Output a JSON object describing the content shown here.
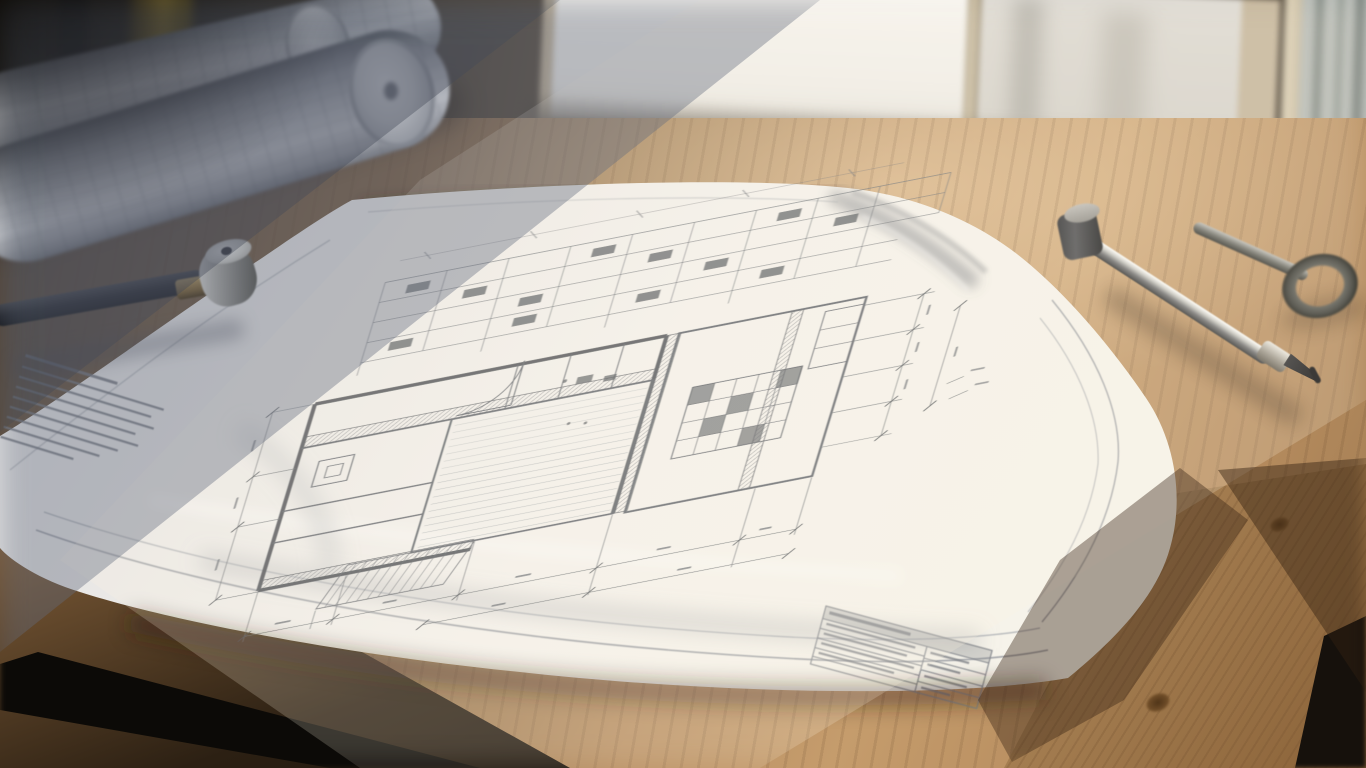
{
  "scene": {
    "type": "photograph",
    "subject": "Hand-drawn architectural blueprint lying on a wooden drafting table beside a sunlit window",
    "lighting": "warm sunlight from upper-right window, cool diagonal shadow across upper-left"
  },
  "objects": {
    "blueprint_sheet": {
      "label": "large white blueprint sheet with pencil floor plan, curled edges"
    },
    "floor_plan": {
      "label": "pencil floor plan with thick hatched walls, rooms, stairs, door-swing arc"
    },
    "elevation_grid": {
      "label": "grid-like elevation band along top of the drawing"
    },
    "dimension_lines": {
      "label": "dimension chains with oblique tick marks and illegible measurements"
    },
    "notes_block": {
      "label": "block of eight illegible note lines at left margin",
      "line_count": 8
    },
    "title_block": {
      "label": "illegible title block table at bottom-right of sheet",
      "row_count": 5
    },
    "sheet_border": {
      "label": "double ruled border following the sheet edges"
    },
    "rolled_blueprints": {
      "label": "two rolled-up blueprint sheets in shadow, top-left"
    },
    "drafting_pen": {
      "label": "black drafting pen with brass band and round steel cap"
    },
    "compass": {
      "label": "steel drafting compass with black knob, needle tip and ring handle"
    },
    "window": {
      "label": "bright window with cream frame"
    },
    "side_window": {
      "label": "narrow window pane at right edge showing blurred exterior"
    },
    "table": {
      "label": "oak table top in warm light"
    },
    "plank": {
      "label": "pine bench plank with knots, bottom-right"
    },
    "table_leg_left": {
      "label": "dark metal table leg, bottom-left"
    },
    "table_leg_right": {
      "label": "dark metal leg, bottom-right corner"
    },
    "yellow_tool": {
      "label": "blurred yellow tool standing in dark background"
    }
  },
  "palette": {
    "paper_lit": "#f4f1ec",
    "paper_shadow": "#b7bac2",
    "pencil_line": "#5f646b",
    "wall_dark": "#43474c",
    "wood_lit": "#c79f6e",
    "wood_shadow": "#5e4a35",
    "window_frame": "#c2b399",
    "window_glass": "#f5f3ef",
    "background_dark": "#1c1710",
    "steel": "#c9c9c4",
    "brass": "#ab9058"
  }
}
